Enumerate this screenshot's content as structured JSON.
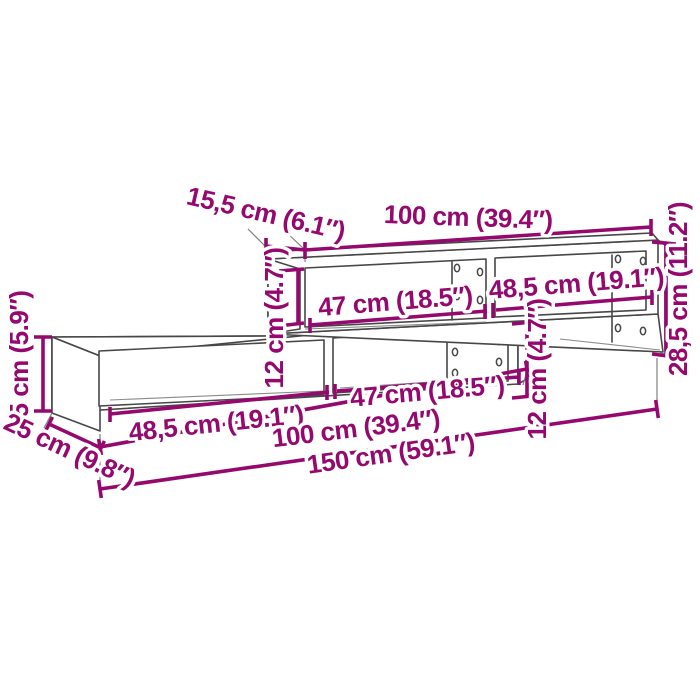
{
  "diagram": {
    "kind": "furniture-dimension-diagram",
    "subject": "wall-mounted staggered TV shelf unit, perspective line drawing",
    "background_color": "#FFFFFF",
    "accent_color": "#95096F",
    "outline_color": "#474747",
    "dimensions": [
      {
        "id": "top-depth",
        "label": "15,5 cm (6.1″)"
      },
      {
        "id": "top-width",
        "label": "100 cm (39.4″)"
      },
      {
        "id": "right-total-height",
        "label": "28,5 cm (11.2″)"
      },
      {
        "id": "upper-inner-height",
        "label": "12 cm (4.7″)"
      },
      {
        "id": "upper-left-compartment",
        "label": "47 cm (18.5″)"
      },
      {
        "id": "upper-right-compartment",
        "label": "48,5 cm (19.1″)"
      },
      {
        "id": "left-height",
        "label": "15 cm (5.9″)"
      },
      {
        "id": "lower-left-compartment",
        "label": "48,5 cm (19.1″)"
      },
      {
        "id": "lower-right-compartment",
        "label": "47 cm (18.5″)"
      },
      {
        "id": "lower-inner-height",
        "label": "12 cm (4.7″)"
      },
      {
        "id": "lower-width",
        "label": "100 cm (39.4″)"
      },
      {
        "id": "depth",
        "label": "25 cm (9.8″)"
      },
      {
        "id": "total-width",
        "label": "150 cm (59.1″)"
      }
    ]
  }
}
